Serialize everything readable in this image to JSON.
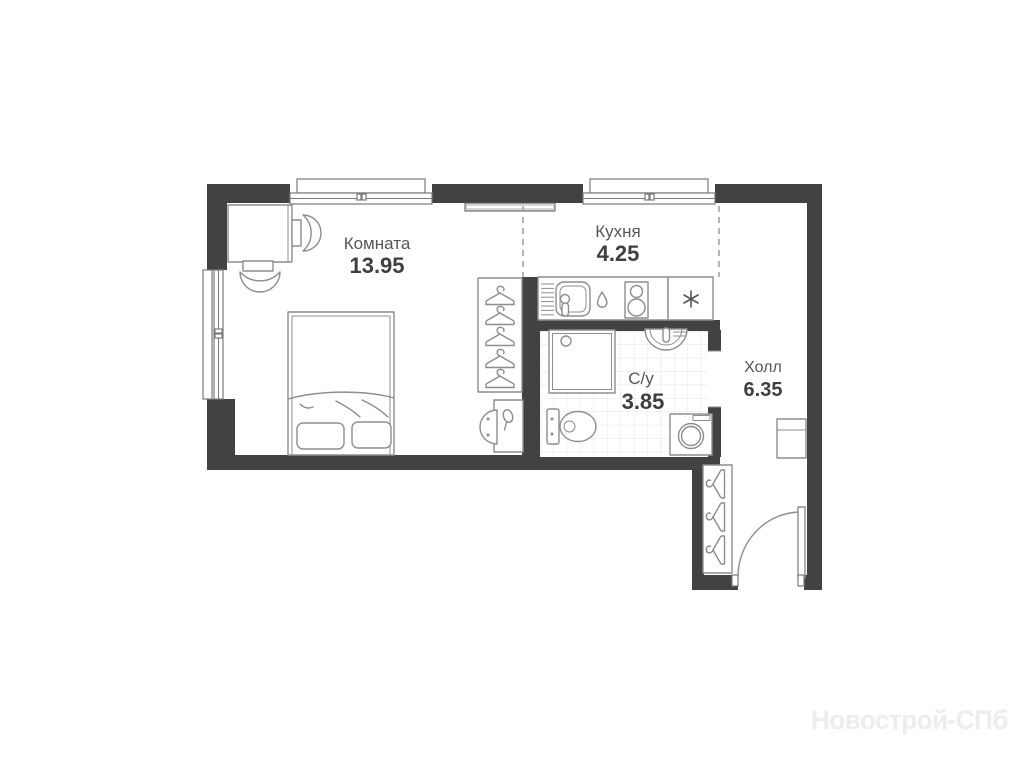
{
  "rooms": {
    "living_room": {
      "label": "Комната",
      "area": "13.95"
    },
    "kitchen": {
      "label": "Кухня",
      "area": "4.25"
    },
    "bathroom": {
      "label": "С/у",
      "area": "3.85"
    },
    "hall": {
      "label": "Холл",
      "area": "6.35"
    }
  },
  "watermark": {
    "text": "Новострой-СПб"
  },
  "colors": {
    "wall": "#424242",
    "furniture_outline": "#8d8d8d",
    "room_label": "#565656",
    "area_label": "#3f3f3f",
    "tile_line": "#e4e4e4",
    "dashed_zone_line": "#a3a3a3",
    "watermark": "#ededed"
  }
}
